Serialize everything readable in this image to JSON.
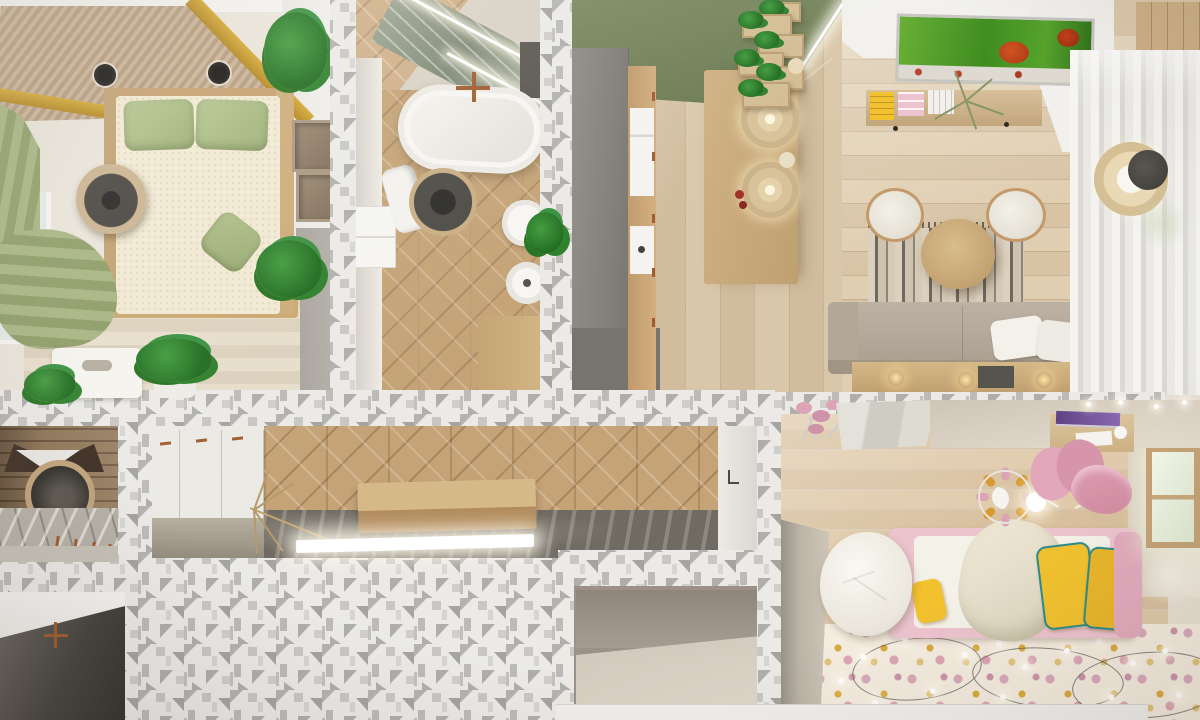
{
  "meta": {
    "title": "Top-down 3D render of a small apartment interior",
    "view": "bird's-eye cutaway floor plan render",
    "canvas": {
      "width": 1200,
      "height": 720
    }
  },
  "palette": {
    "mosaic-bg": "#ebeae7",
    "mosaic-gray-1": "#b4b3b0",
    "mosaic-gray-2": "#a5a4a1",
    "mosaic-gray-3": "#cfcecb",
    "gold": "#d3a733",
    "green-wall": "#7a8960",
    "curtain-green": "#a6b381",
    "pillow-green": "#b3c48e",
    "wood-mid": "#cfb183",
    "parquet": "#c5a377",
    "art-green": "#64ad31",
    "art-red": "#c44018",
    "copper": "#a05c30",
    "sofa": "#bdb2a4",
    "rustic": "#8f7456",
    "pink": "#ecc3ce",
    "pink-deep": "#dca4b6",
    "yellow": "#f1c12e",
    "teal": "#2e8b8b",
    "rug-kids": "#f4ecdf"
  },
  "rooms": {
    "bedroom": {
      "label": "Bedroom",
      "objects": [
        "wood-slat ceiling with gold trim",
        "double bed with green pillows",
        "round rattan pendant lamp",
        "green roman curtain",
        "window",
        "wall cube shelves",
        "potted plants",
        "storage bench"
      ]
    },
    "bathroom": {
      "label": "Bathroom",
      "objects": [
        "freestanding oval bathtub",
        "copper faucet",
        "round dark rug",
        "toilet",
        "round vessel sink",
        "chevron wood tile floor",
        "green marble ceiling strip with LED lines",
        "towel",
        "plant",
        "vanity"
      ]
    },
    "kitchen": {
      "label": "Kitchen",
      "objects": [
        "olive green accent wall",
        "tall gray cabinet column",
        "wood counter with appliances",
        "kitchen island",
        "two drum pendant lamps",
        "zigzag plant shelves",
        "cove lighting"
      ]
    },
    "living_room": {
      "label": "Living room",
      "objects": [
        "green botanical artwork",
        "wall shelf with books",
        "dried branch decor",
        "striped rug",
        "two cream poufs",
        "round wood coffee table",
        "beige sofa with white pillows",
        "media console with spotlights",
        "sheer curtains",
        "drum floor lamp"
      ]
    },
    "entry": {
      "label": "Entry hall",
      "objects": [
        "rustic wood wall",
        "round gong mirror",
        "dark wing decor",
        "marble console",
        "copper coat hooks"
      ]
    },
    "utility": {
      "label": "Utility room",
      "objects": [
        "dark floor",
        "copper faucet"
      ]
    },
    "corridor": {
      "label": "Corridor",
      "objects": [
        "white built-in cabinets with copper handles",
        "diamond parquet wall",
        "dark marble floor",
        "wood bench",
        "branch decoration",
        "LED light bar"
      ]
    },
    "closet": {
      "label": "Walk-in closet",
      "objects": [
        "taupe walls",
        "beige floor"
      ]
    },
    "kids_room": {
      "label": "Kids bedroom",
      "objects": [
        "pink bed with white duvet",
        "yellow pillows with teal trim",
        "white bean bag",
        "pink butterfly desk chairs",
        "desk with purple laptop",
        "pink carousel pendant with moon",
        "floral rug",
        "string lights",
        "bright window",
        "gray wardrobe",
        "pink dried flowers"
      ]
    }
  },
  "structure": {
    "walls": "cut walls shown with white-gray triangular mosaic texture"
  }
}
